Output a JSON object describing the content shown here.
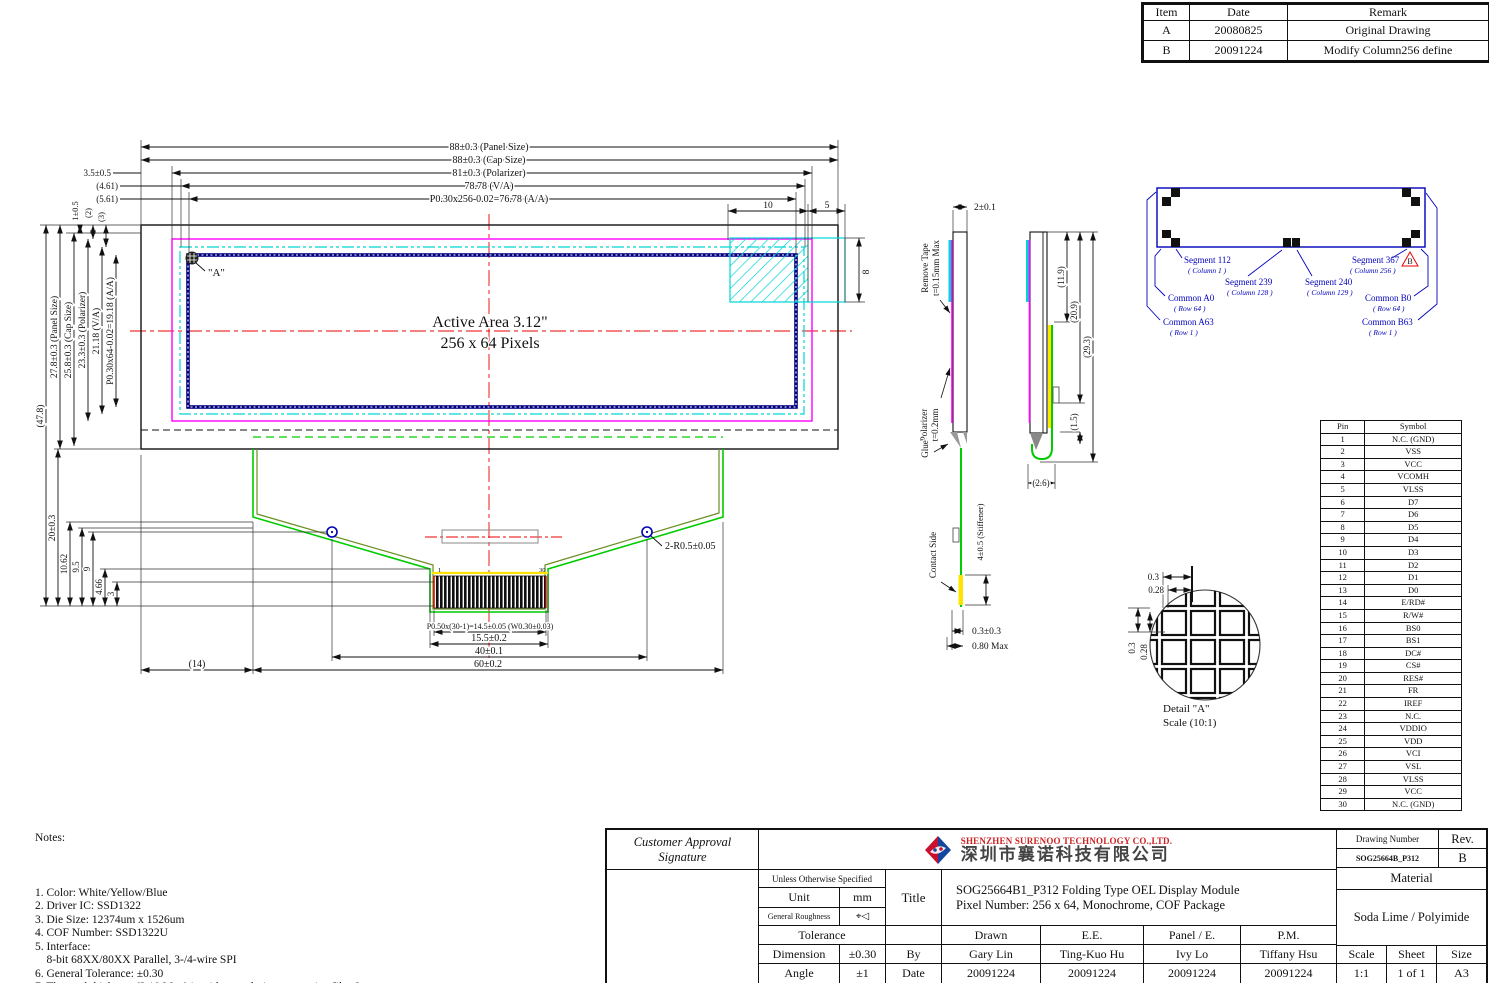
{
  "revision_table": {
    "headers": [
      "Item",
      "Date",
      "Remark"
    ],
    "rows": [
      [
        "A",
        "20080825",
        "Original Drawing"
      ],
      [
        "B",
        "20091224",
        "Modify Column256 define"
      ]
    ]
  },
  "front_view": {
    "active_area_line1": "Active Area 3.12\"",
    "active_area_line2": "256 x 64 Pixels",
    "corner_label": "\"A\""
  },
  "dims": {
    "panel_w": "88±0.3 (Panel Size)",
    "cap_w": "88±0.3 (Cap Size)",
    "pol_w": "81±0.3 (Polarizer)",
    "va_w": "78.78 (V/A)",
    "aa_w": "P0.30x256-0.02=76.78 (A/A)",
    "d35": "3.5±0.5",
    "d461": "(4.61)",
    "d561": "(5.61)",
    "d10": "10",
    "d5": "5",
    "d8": "8",
    "total_h": "(47.8)",
    "panel_h": "27.8±0.3 (Panel Size)",
    "cap_h": "25.8±0.3 (Cap Size)",
    "pol_h": "23.3±0.3 (Polarizer)",
    "va_h": "21.18 (V/A)",
    "aa_h": "P0.30x64-0.02=19.18 (A/A)",
    "d1": "1±0.5",
    "d2": "(2)",
    "d3": "(3)",
    "d20": "20±0.3",
    "d1062": "10.62",
    "d95": "9.5",
    "d9": "9",
    "d466": "4.66",
    "d3b": "3",
    "d14": "(14)",
    "d60": "60±0.2",
    "d40": "40±0.1",
    "d155": "15.5±0.2",
    "pitch": "P0.50x(30-1)=14.5±0.05 (W0.30±0.03)",
    "holes": "2-R0.5±0.05",
    "pin_first": "1",
    "pin_last": "30",
    "d201": "2±0.1",
    "remove_tape1": "Remove Tape",
    "remove_tape2": "t=0.15mm Max",
    "polarizer1": "Polarizer",
    "polarizer2": "t=0.2mm",
    "glue": "Glue",
    "contact_side": "Contact Side",
    "stiffener": "4±0.5 (Stiffener)",
    "d0303": "0.3±0.3",
    "d080": "0.80 Max",
    "d119": "(11.9)",
    "d209": "(20.9)",
    "d293": "(29.3)",
    "d15": "(1.5)",
    "d26": "(2.6)"
  },
  "rear_view": {
    "seg112": "Segment 112",
    "seg112_sub": "( Column 1 )",
    "seg239": "Segment 239",
    "seg239_sub": "( Column 128 )",
    "seg240": "Segment 240",
    "seg240_sub": "( Column 129 )",
    "seg367": "Segment 367",
    "seg367_sub": "( Column 256 )",
    "comA0": "Common A0",
    "comA0_sub": "( Row 64 )",
    "comA63": "Common A63",
    "comA63_sub": "( Row 1 )",
    "comB0": "Common B0",
    "comB0_sub": "( Row 64 )",
    "comB63": "Common B63",
    "comB63_sub": "( Row 1 )",
    "rev_mark": "B"
  },
  "detail_a": {
    "d03h": "0.3",
    "d028h": "0.28",
    "d03v": "0.3",
    "d028v": "0.28",
    "label": "Detail \"A\"",
    "scale": "Scale (10:1)"
  },
  "pin_table": {
    "headers": [
      "Pin",
      "Symbol"
    ],
    "rows": [
      [
        "1",
        "N.C. (GND)"
      ],
      [
        "2",
        "VSS"
      ],
      [
        "3",
        "VCC"
      ],
      [
        "4",
        "VCOMH"
      ],
      [
        "5",
        "VLSS"
      ],
      [
        "6",
        "D7"
      ],
      [
        "7",
        "D6"
      ],
      [
        "8",
        "D5"
      ],
      [
        "9",
        "D4"
      ],
      [
        "10",
        "D3"
      ],
      [
        "11",
        "D2"
      ],
      [
        "12",
        "D1"
      ],
      [
        "13",
        "D0"
      ],
      [
        "14",
        "E/RD#"
      ],
      [
        "15",
        "R/W#"
      ],
      [
        "16",
        "BS0"
      ],
      [
        "17",
        "BS1"
      ],
      [
        "18",
        "DC#"
      ],
      [
        "19",
        "CS#"
      ],
      [
        "20",
        "RES#"
      ],
      [
        "21",
        "FR"
      ],
      [
        "22",
        "IREF"
      ],
      [
        "23",
        "N.C."
      ],
      [
        "24",
        "VDDIO"
      ],
      [
        "25",
        "VDD"
      ],
      [
        "26",
        "VCI"
      ],
      [
        "27",
        "VSL"
      ],
      [
        "28",
        "VLSS"
      ],
      [
        "29",
        "VCC"
      ],
      [
        "30",
        "N.C. (GND)"
      ]
    ]
  },
  "notes": {
    "title": "Notes:",
    "lines": [
      "1. Color: White/Yellow/Blue",
      "2. Driver IC: SSD1322",
      "3. Die Size: 12374um x 1526um",
      "4. COF Number: SSD1322U",
      "5. Interface:",
      "    8-bit 68XX/80XX Parallel, 3-/4-wire SPI",
      "6. General Tolerance: ±0.30",
      "7. The total thickness (2.10 Max) is without polarizer protective film & remove tape.",
      "    The actual assembled total thickness with above materials should be 2.35 Max."
    ]
  },
  "title_block": {
    "ca1": "Customer Approval",
    "ca2": "Signature",
    "company_en": "SHENZHEN SURENOO TECHNOLOGY CO.,LTD.",
    "company_cn": "深圳市襄诺科技有限公司",
    "unless": "Unless Otherwise Specified",
    "unit_label": "Unit",
    "unit_value": "mm",
    "roughness_label": "General Roughness",
    "roughness_symbol": "⌖◁",
    "title_label": "Title",
    "title_line1": "SOG25664B1_P312 Folding Type OEL Display Module",
    "title_line2": "Pixel Number: 256 x 64, Monochrome, COF Package",
    "tolerance_label": "Tolerance",
    "dim_label": "Dimension",
    "dim_value": "±0.30",
    "angle_label": "Angle",
    "angle_value": "±1",
    "by_label": "By",
    "date_label": "Date",
    "col_drawn": "Drawn",
    "col_ee": "E.E.",
    "col_panel": "Panel / E.",
    "col_pm": "P.M.",
    "name_drawn": "Gary Lin",
    "name_ee": "Ting-Kuo Hu",
    "name_panel": "Ivy Lo",
    "name_pm": "Tiffany Hsu",
    "date_drawn": "20091224",
    "date_ee": "20091224",
    "date_panel": "20091224",
    "date_pm": "20091224",
    "drawing_number_label": "Drawing Number",
    "drawing_number": "SOG25664B_P312",
    "rev_label": "Rev.",
    "rev_value": "B",
    "material_label": "Material",
    "material_value": "Soda Lime / Polyimide",
    "scale_label": "Scale",
    "scale_value": "1:1",
    "sheet_label": "Sheet",
    "sheet_value": "1 of 1",
    "size_label": "Size",
    "size_value": "A3"
  },
  "colors": {
    "magenta": "#ff00ff",
    "cyan": "#00d5d5",
    "rear_blue": "#0000bb",
    "aa_navy": "#000080",
    "green": "#00cc00",
    "olive": "#6b8e23",
    "yellow": "#ffe400",
    "red": "#ee0000"
  }
}
